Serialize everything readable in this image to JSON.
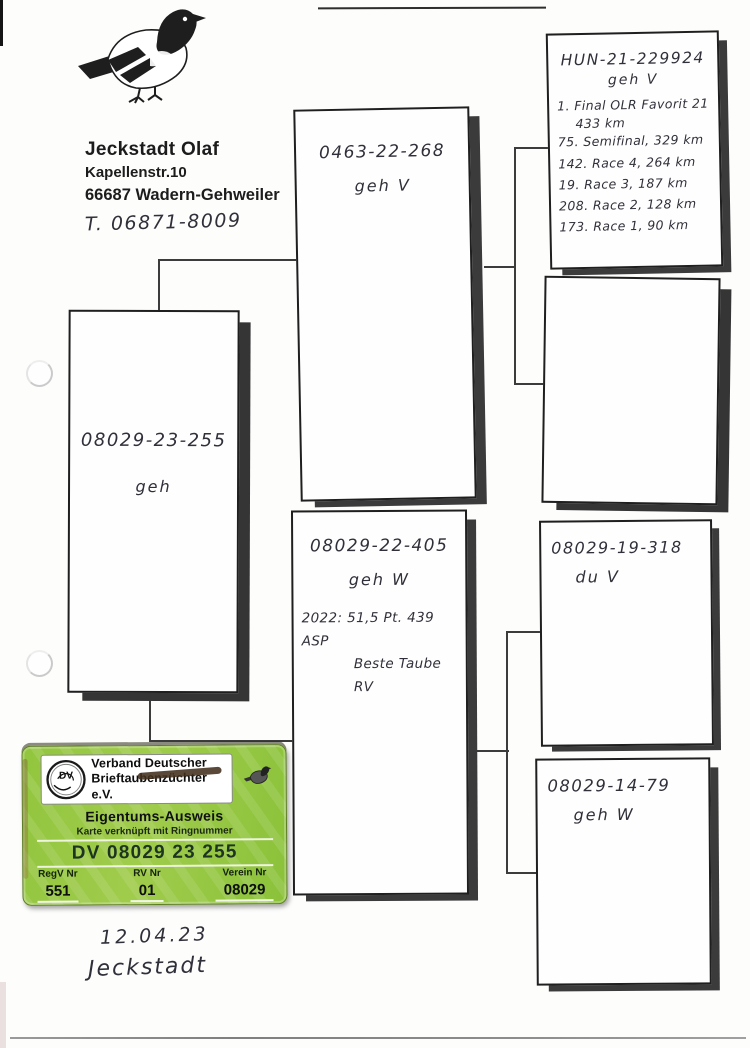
{
  "owner": {
    "name": "Jeckstadt Olaf",
    "street": "Kapellenstr.10",
    "city": "66687 Wadern-Gehweiler",
    "phone": "T. 06871-8009"
  },
  "pedigree": {
    "subject": {
      "ring": "08029-23-255",
      "sex": "geh"
    },
    "father": {
      "ring": "0463-22-268",
      "sex": "geh V"
    },
    "mother": {
      "ring": "08029-22-405",
      "sex": "geh W",
      "results": [
        "2022: 51,5 Pt. 439 ASP",
        "Beste Taube RV"
      ]
    },
    "gfp": {
      "ring": "HUN-21-229924",
      "sex": "geh V",
      "results": [
        "1. Final OLR Favorit 21",
        "433 km",
        "75. Semifinal, 329 km",
        "142. Race 4, 264 km",
        "19. Race 3, 187 km",
        "208. Race 2, 128 km",
        "173. Race 1, 90 km"
      ]
    },
    "gmp": {
      "ring": "",
      "sex": ""
    },
    "gfm": {
      "ring": "08029-19-318",
      "sex": "du V"
    },
    "gmm": {
      "ring": "08029-14-79",
      "sex": "geh W"
    }
  },
  "sticker": {
    "logo_text": "DV",
    "org_line1": "Verband Deutscher",
    "org_line2": "Brieftaubenzüchter e.V.",
    "title": "Eigentums-Ausweis",
    "subtitle": "Karte verknüpft mit Ringnummer",
    "ring_number": "DV 08029 23 255",
    "fields": [
      {
        "label": "RegV Nr",
        "value": "551"
      },
      {
        "label": "RV Nr",
        "value": "01"
      },
      {
        "label": "Verein Nr",
        "value": "08029"
      }
    ],
    "colors": {
      "green": "#8dc63f",
      "dark_text": "#1d3520"
    }
  },
  "footer": {
    "date": "12.04.23",
    "signature": "Jeckstadt"
  }
}
